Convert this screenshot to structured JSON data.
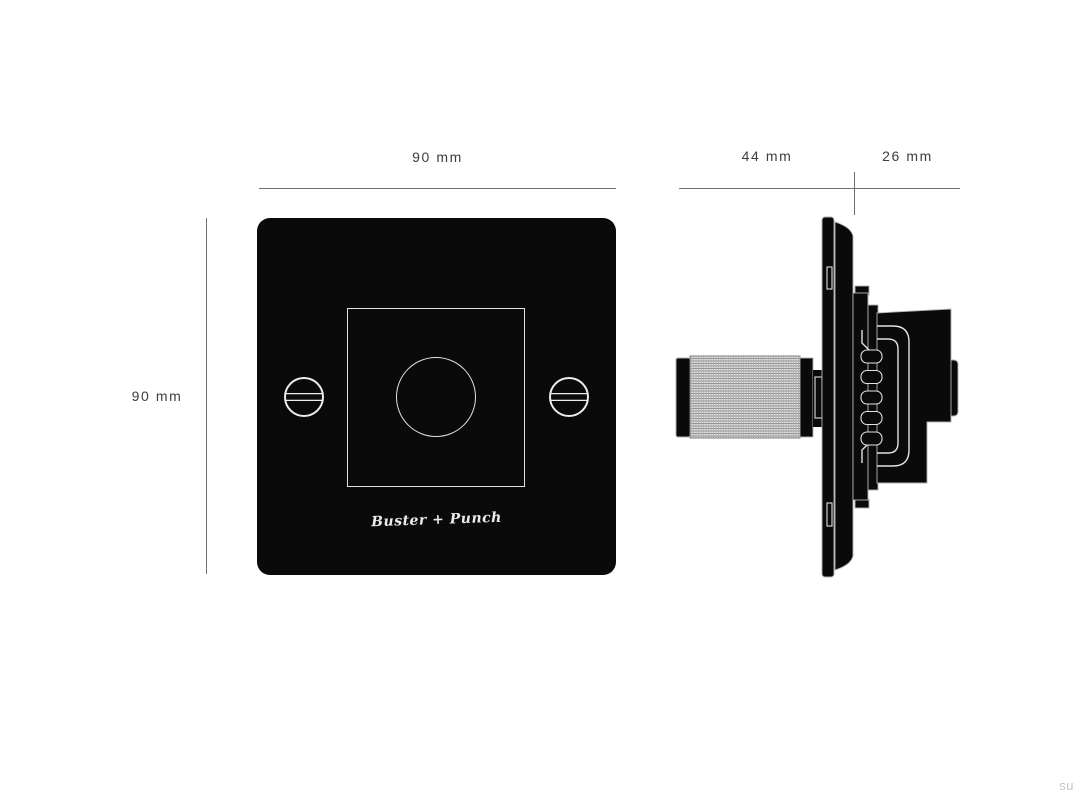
{
  "dimensions": {
    "front_width": "90 mm",
    "front_height": "90 mm",
    "side_front_depth": "44 mm",
    "side_back_depth": "26 mm"
  },
  "branding": {
    "logo_text": "Buster + Punch"
  },
  "watermark": "su",
  "colors": {
    "background": "#ffffff",
    "plate": "#0a0a0a",
    "dim-line": "#6e6e6e",
    "dim-text": "#3d3d3d",
    "outline-light": "#e2e2e2",
    "knurl-base": "#e3e3e3",
    "watermark-text": "#c4c4c4"
  }
}
